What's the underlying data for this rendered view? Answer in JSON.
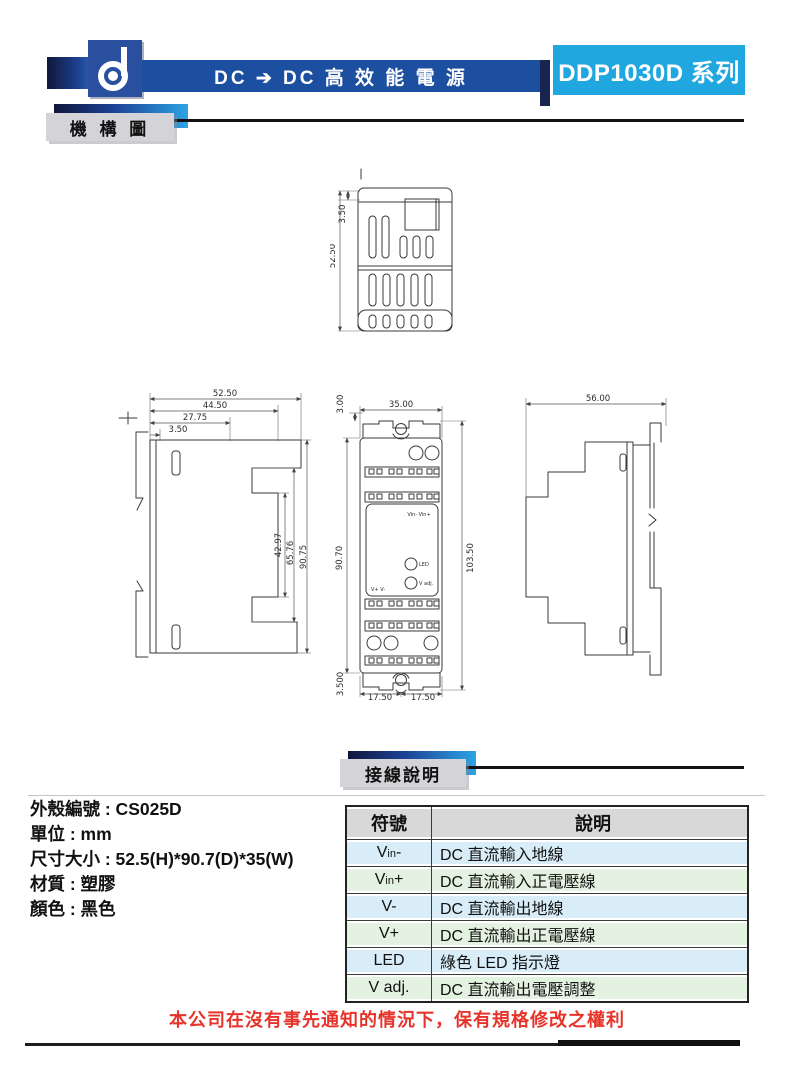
{
  "header": {
    "banner_title": "DC ➔ DC 高 效 能 電 源",
    "series_badge": "DDP1030D 系列"
  },
  "sections": {
    "mechanism_label": "機 構 圖",
    "wiring_label": "接線說明"
  },
  "drawings": {
    "top_view": {
      "dim_cap": "3.50",
      "dim_depth": "52.50"
    },
    "left_view": {
      "dim_w1": "52.50",
      "dim_w2": "44.50",
      "dim_w3": "27.75",
      "dim_w4": "3.50",
      "dim_h1": "42.97",
      "dim_h2": "65.76",
      "dim_h3": "90.75"
    },
    "front_view": {
      "dim_top_offset": "3.00",
      "dim_width": "35.00",
      "dim_body_height": "90.70",
      "dim_total_height": "103.50",
      "dim_bottom_offset": "3.500",
      "dim_half_left": "17.50",
      "dim_half_right": "17.50",
      "label_input": "Vin- Vin+",
      "label_output": "V+  V-",
      "label_led": "LED",
      "label_vadj": "V adj."
    },
    "right_view": {
      "dim_depth": "56.00"
    }
  },
  "specs": {
    "line1": "外殼編號 : CS025D",
    "line2": "單位 : mm",
    "line3": "尺寸大小 : 52.5(H)*90.7(D)*35(W)",
    "line4": "材質 : 塑膠",
    "line5": "顏色 : 黑色"
  },
  "wiring_table": {
    "header_symbol": "符號",
    "header_description": "說明",
    "rows": [
      {
        "main": "V",
        "sub": "in",
        "suffix": "-",
        "description": "DC 直流輸入地線"
      },
      {
        "main": "V",
        "sub": "in",
        "suffix": "+",
        "description": "DC 直流輸入正電壓線"
      },
      {
        "main": "V",
        "sub": "",
        "suffix": "-",
        "description": "DC 直流輸出地線"
      },
      {
        "main": "V",
        "sub": "",
        "suffix": "+",
        "description": "DC 直流輸出正電壓線"
      },
      {
        "main": "LED",
        "sub": "",
        "suffix": "",
        "description": "綠色 LED 指示燈"
      },
      {
        "main": "V adj.",
        "sub": "",
        "suffix": "",
        "description": "DC 直流輸出電壓調整"
      }
    ]
  },
  "footer": {
    "notice": "本公司在沒有事先通知的情況下，保有規格修改之權利"
  },
  "colors": {
    "banner_blue": "#1d4fa1",
    "series_cyan": "#21a7e0",
    "notice_red": "#e6342b",
    "row_blue": "#d9edf8",
    "row_green": "#e4f2e1",
    "header_gray": "#d8d8d8"
  }
}
